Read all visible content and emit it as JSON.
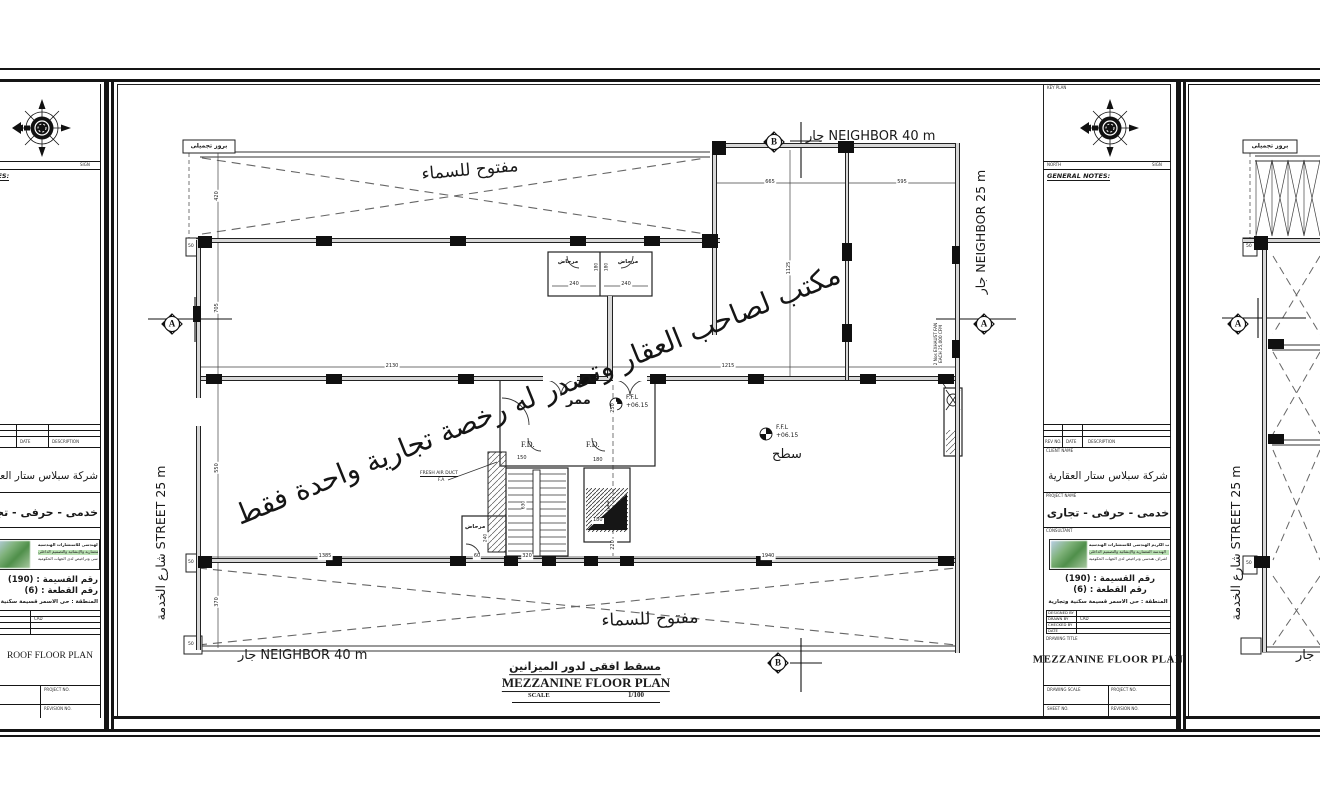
{
  "colors": {
    "line": "#1a1a1a",
    "wall_fill": "#d8d8d8",
    "logo_green": "#4f8f4a"
  },
  "titleblock": {
    "key_plan": "KEY PLAN",
    "north": "NORTH",
    "sign": "SIGN",
    "general_notes": "GENERAL NOTES:",
    "rev": {
      "rev_no": "REV NO.",
      "date": "DATE",
      "description": "DESCRIPTION"
    },
    "client_label": "CLIENT NAME",
    "client": "شركة سبلاس ستار العقارية",
    "project_label": "PROJECT NAME",
    "project": "خدمى - حرفى - تجارى",
    "consultant_label": "CONSULTANT",
    "consultant_line1": "مكتب الكريم الهندسى للاستشارات الهندسية",
    "consultant_line2": "الهندسة المعمارية والإنشائية والتصميم الداخلى",
    "consultant_line3": "اشراف هندسى وتراخيص لدى الجهات الحكومية",
    "parcel": "رقم القسيمة : (190)",
    "block_no": "رقم القطعة : (6)",
    "district": "المنطقة : حى الاسمر قسيمة سكنية وتجارية",
    "designed_by": "DESIGNED BY",
    "drawn_by": "DRAWN BY",
    "drawn_value": "CAD",
    "checked_by": "CHECKED BY",
    "date_label": "DATE",
    "drawing_title_label": "DRAWING TITLE",
    "drawing_scale": "DRAWING SCALE",
    "project_no": "PROJECT NO.",
    "sheet_no": "SHEET NO.",
    "revision_no": "REVISION NO."
  },
  "sheets": {
    "left": {
      "title": "ROOF FLOOR PLAN"
    },
    "center": {
      "title": "MEZZANINE FLOOR PLAN",
      "caption_ar": "مسقط افقى لدور الميزانين",
      "caption_en": "MEZZANINE  FLOOR  PLAN",
      "scale_label": "SCALE",
      "scale_value": "1/100"
    }
  },
  "plan": {
    "watermark": "مكتب لصاحب العقار وتصدر له رخصة تجارية واحدة فقط",
    "open_sky": "مفتوح للسماء",
    "decor_projection": "بروز تجميلى",
    "neighbor_top": "جار NEIGHBOR 40 m",
    "neighbor_bottom": "جار NEIGHBOR 40 m",
    "neighbor_right": "جار NEIGHBOR 25 m",
    "street": "شارع الخدمة STREET 25 m",
    "jar": "جار",
    "corridor": "ممر",
    "roof": "سطح",
    "toilet": "مرحاض",
    "ffl": "F.F.L",
    "ffl_value": "+06.15",
    "fd": "F.D.",
    "fresh_air1": "FRESH AIR DUCT",
    "fresh_air2": "F.A",
    "exhaust1": "2 Nos EXHAUST FAN",
    "exhaust2": "EACH 25,000 CFM",
    "stair_up": "صعود",
    "marker_a": "A",
    "marker_b": "B",
    "dims": {
      "d420": "420",
      "d705": "705",
      "d550": "550",
      "d370": "370",
      "d2130": "2130",
      "d1215": "1215",
      "d665": "665",
      "d595": "595",
      "d1125": "1125",
      "d1385": "1385",
      "d1940": "1940",
      "d320": "320",
      "d60": "60",
      "d220": "220",
      "d250": "250",
      "d150": "150",
      "d180": "180",
      "d240": "240",
      "d50": "50",
      "d630": "630"
    }
  }
}
